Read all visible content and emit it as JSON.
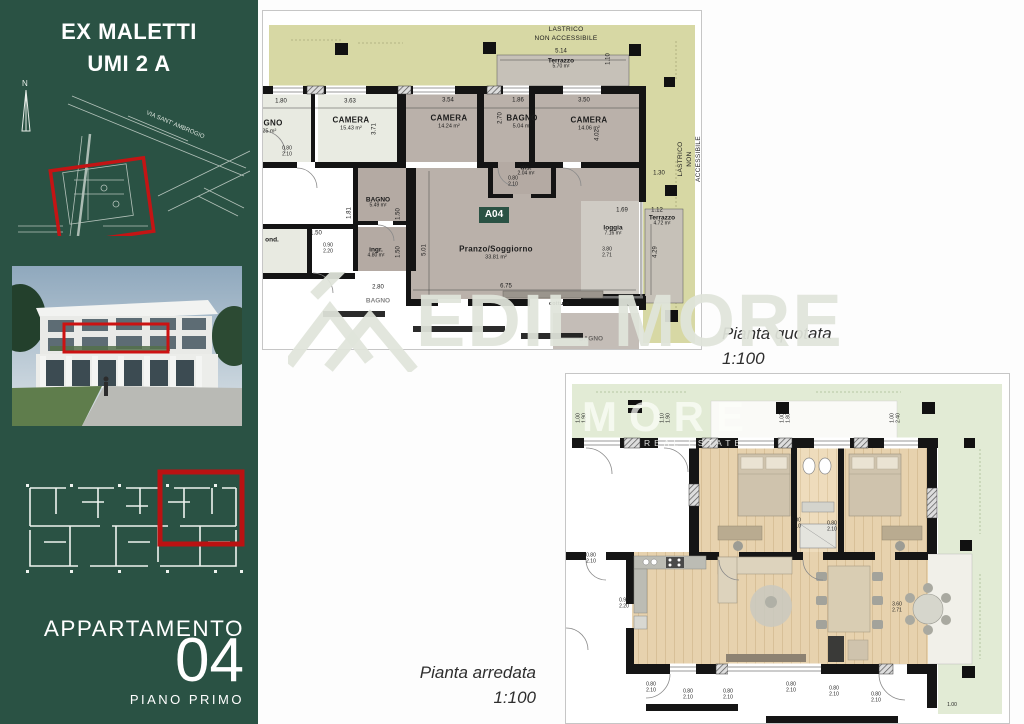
{
  "colors": {
    "sidebar_green": "#2a5244",
    "highlight_red": "#c41414",
    "lastrico_olive": "#d7d8a4",
    "terrace_green": "#e2ebd5",
    "wall_black": "#141414",
    "wood": "#e6d1ac"
  },
  "sidebar": {
    "title_line1": "EX MALETTI",
    "title_line2": "UMI 2 A",
    "north_label": "N",
    "map_street_label": "VIA SANT' AMBROGIO",
    "apartment_label": "APPARTAMENTO",
    "apartment_number": "04",
    "floor_label": "PIANO PRIMO"
  },
  "watermark": {
    "text": "EDIL MORE"
  },
  "plan_quotata": {
    "caption": "Pianta quotata",
    "scale": "1:100",
    "unit_badge": "A04",
    "lastrico_top": "LASTRICO\nNON ACCESSIBILE",
    "lastrico_right": "LASTRICO\nNON ACCESSIBILE",
    "rooms": [
      {
        "name": "BAGNO",
        "area": "7.25 m²"
      },
      {
        "name": "CAMERA",
        "area": "15.43 m²"
      },
      {
        "name": "CAMERA",
        "area": "14.24 m²"
      },
      {
        "name": "BAGNO",
        "area": "5.04 m²"
      },
      {
        "name": "CAMERA",
        "area": "14.06 m²"
      },
      {
        "name": "dis.",
        "area": "2.04 m²"
      },
      {
        "name": "BAGNO",
        "area": "5.49 m²"
      },
      {
        "name": "ingr.",
        "area": "4.80 m²"
      },
      {
        "name": "Pranzo/Soggiorno",
        "area": "33.81 m²"
      },
      {
        "name": "loggia",
        "area": "7.16 m²"
      },
      {
        "name": "Terrazzo",
        "area": "5.70 m²"
      },
      {
        "name": "Terrazzo",
        "area": "4.72 m²"
      },
      {
        "name": "ond.",
        "area": ""
      },
      {
        "name": "BAGNO",
        "area": ""
      },
      {
        "name": "BAGNO",
        "area": ""
      },
      {
        "name": "cottura",
        "area": ""
      }
    ],
    "dims_h": [
      "5.14",
      "1.80",
      "3.63",
      "3.54",
      "1.86",
      "3.50",
      "1.30",
      "1.69",
      "1.12",
      "1.50",
      "2.80",
      "6.75"
    ],
    "dims_v": [
      "1.10",
      "3.71",
      "2.70",
      "4.02",
      "1.81",
      "1.50",
      "1.50",
      "5.01",
      "4.29"
    ],
    "pairs": [
      "0.80\n2.10",
      "0.90\n2.20",
      "3.80\n2.71",
      "0.80\n2.10"
    ]
  },
  "plan_arredata": {
    "caption": "Pianta arredata",
    "scale": "1:100",
    "watermark_line1": "MORE",
    "watermark_line2": "REAL ESTATE",
    "pairs_rot": [
      "1.00\n1.90",
      "1.10\n1.90",
      "1.00\n1.80",
      "1.00\n2.40"
    ],
    "pairs": [
      "0.80\n2.10",
      "0.80\n2.10",
      "0.80\n2.10",
      "0.90\n2.20",
      "3.60\n2.71",
      "0.80\n2.10",
      "0.80\n2.10",
      "0.80\n2.10",
      "0.80\n2.10",
      "0.80\n2.10",
      "0.80\n2.10",
      "1.00"
    ]
  }
}
